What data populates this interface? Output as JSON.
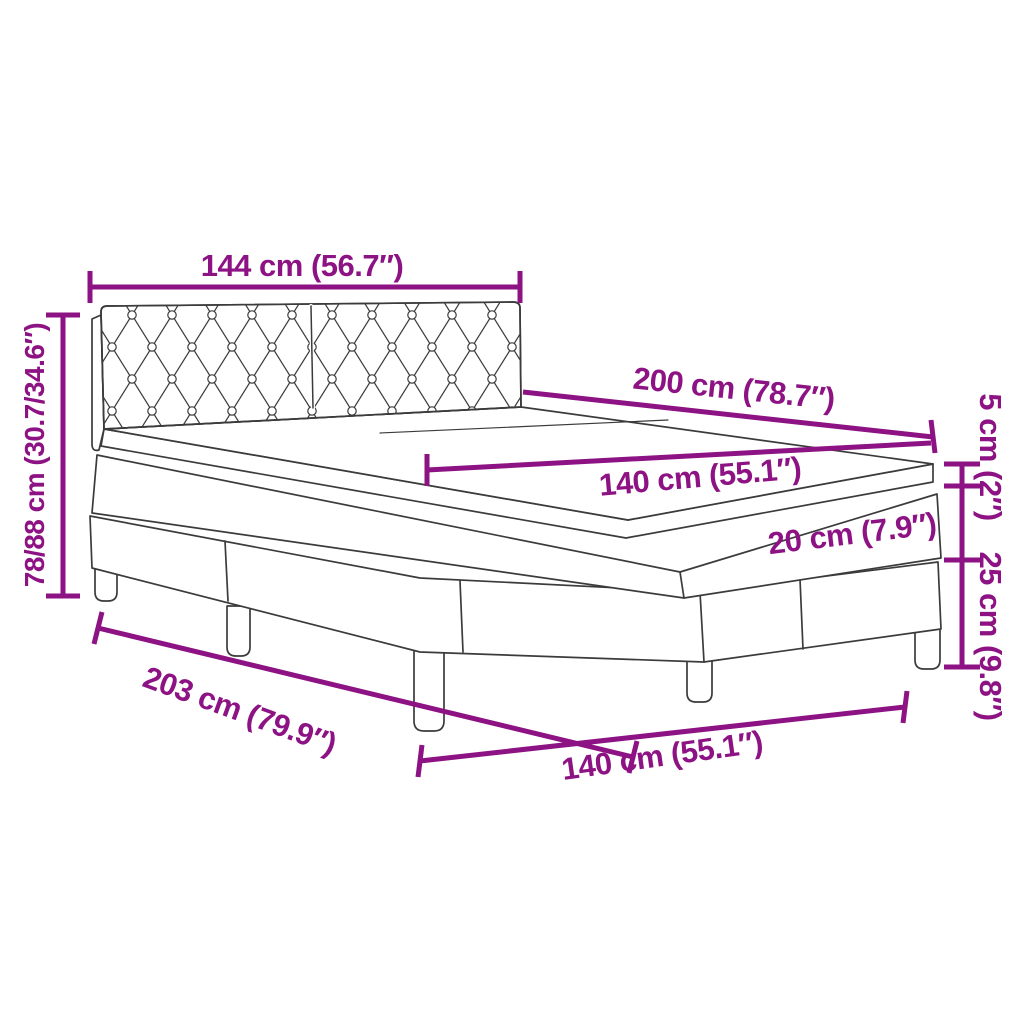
{
  "diagram": {
    "type": "product-dimension-diagram",
    "subject": "box spring bed with tufted headboard, mattress and topper",
    "accent_color": "#8D1283",
    "outline_color": "#3B3B3B",
    "background_color": "#FFFFFF"
  },
  "labels": {
    "headboard_width": "144 cm (56.7″)",
    "headboard_height": "78/88 cm (30.7/34.6″)",
    "bed_length": "200 cm (78.7″)",
    "mattress_width": "140 cm (55.1″)",
    "topper_thickness": "5 cm (2″)",
    "mattress_thickness": "20 cm (7.9″)",
    "base_height": "25 cm (9.8″)",
    "total_length": "203 cm (79.9″)",
    "foot_width": "140 cm (55.1″)"
  }
}
